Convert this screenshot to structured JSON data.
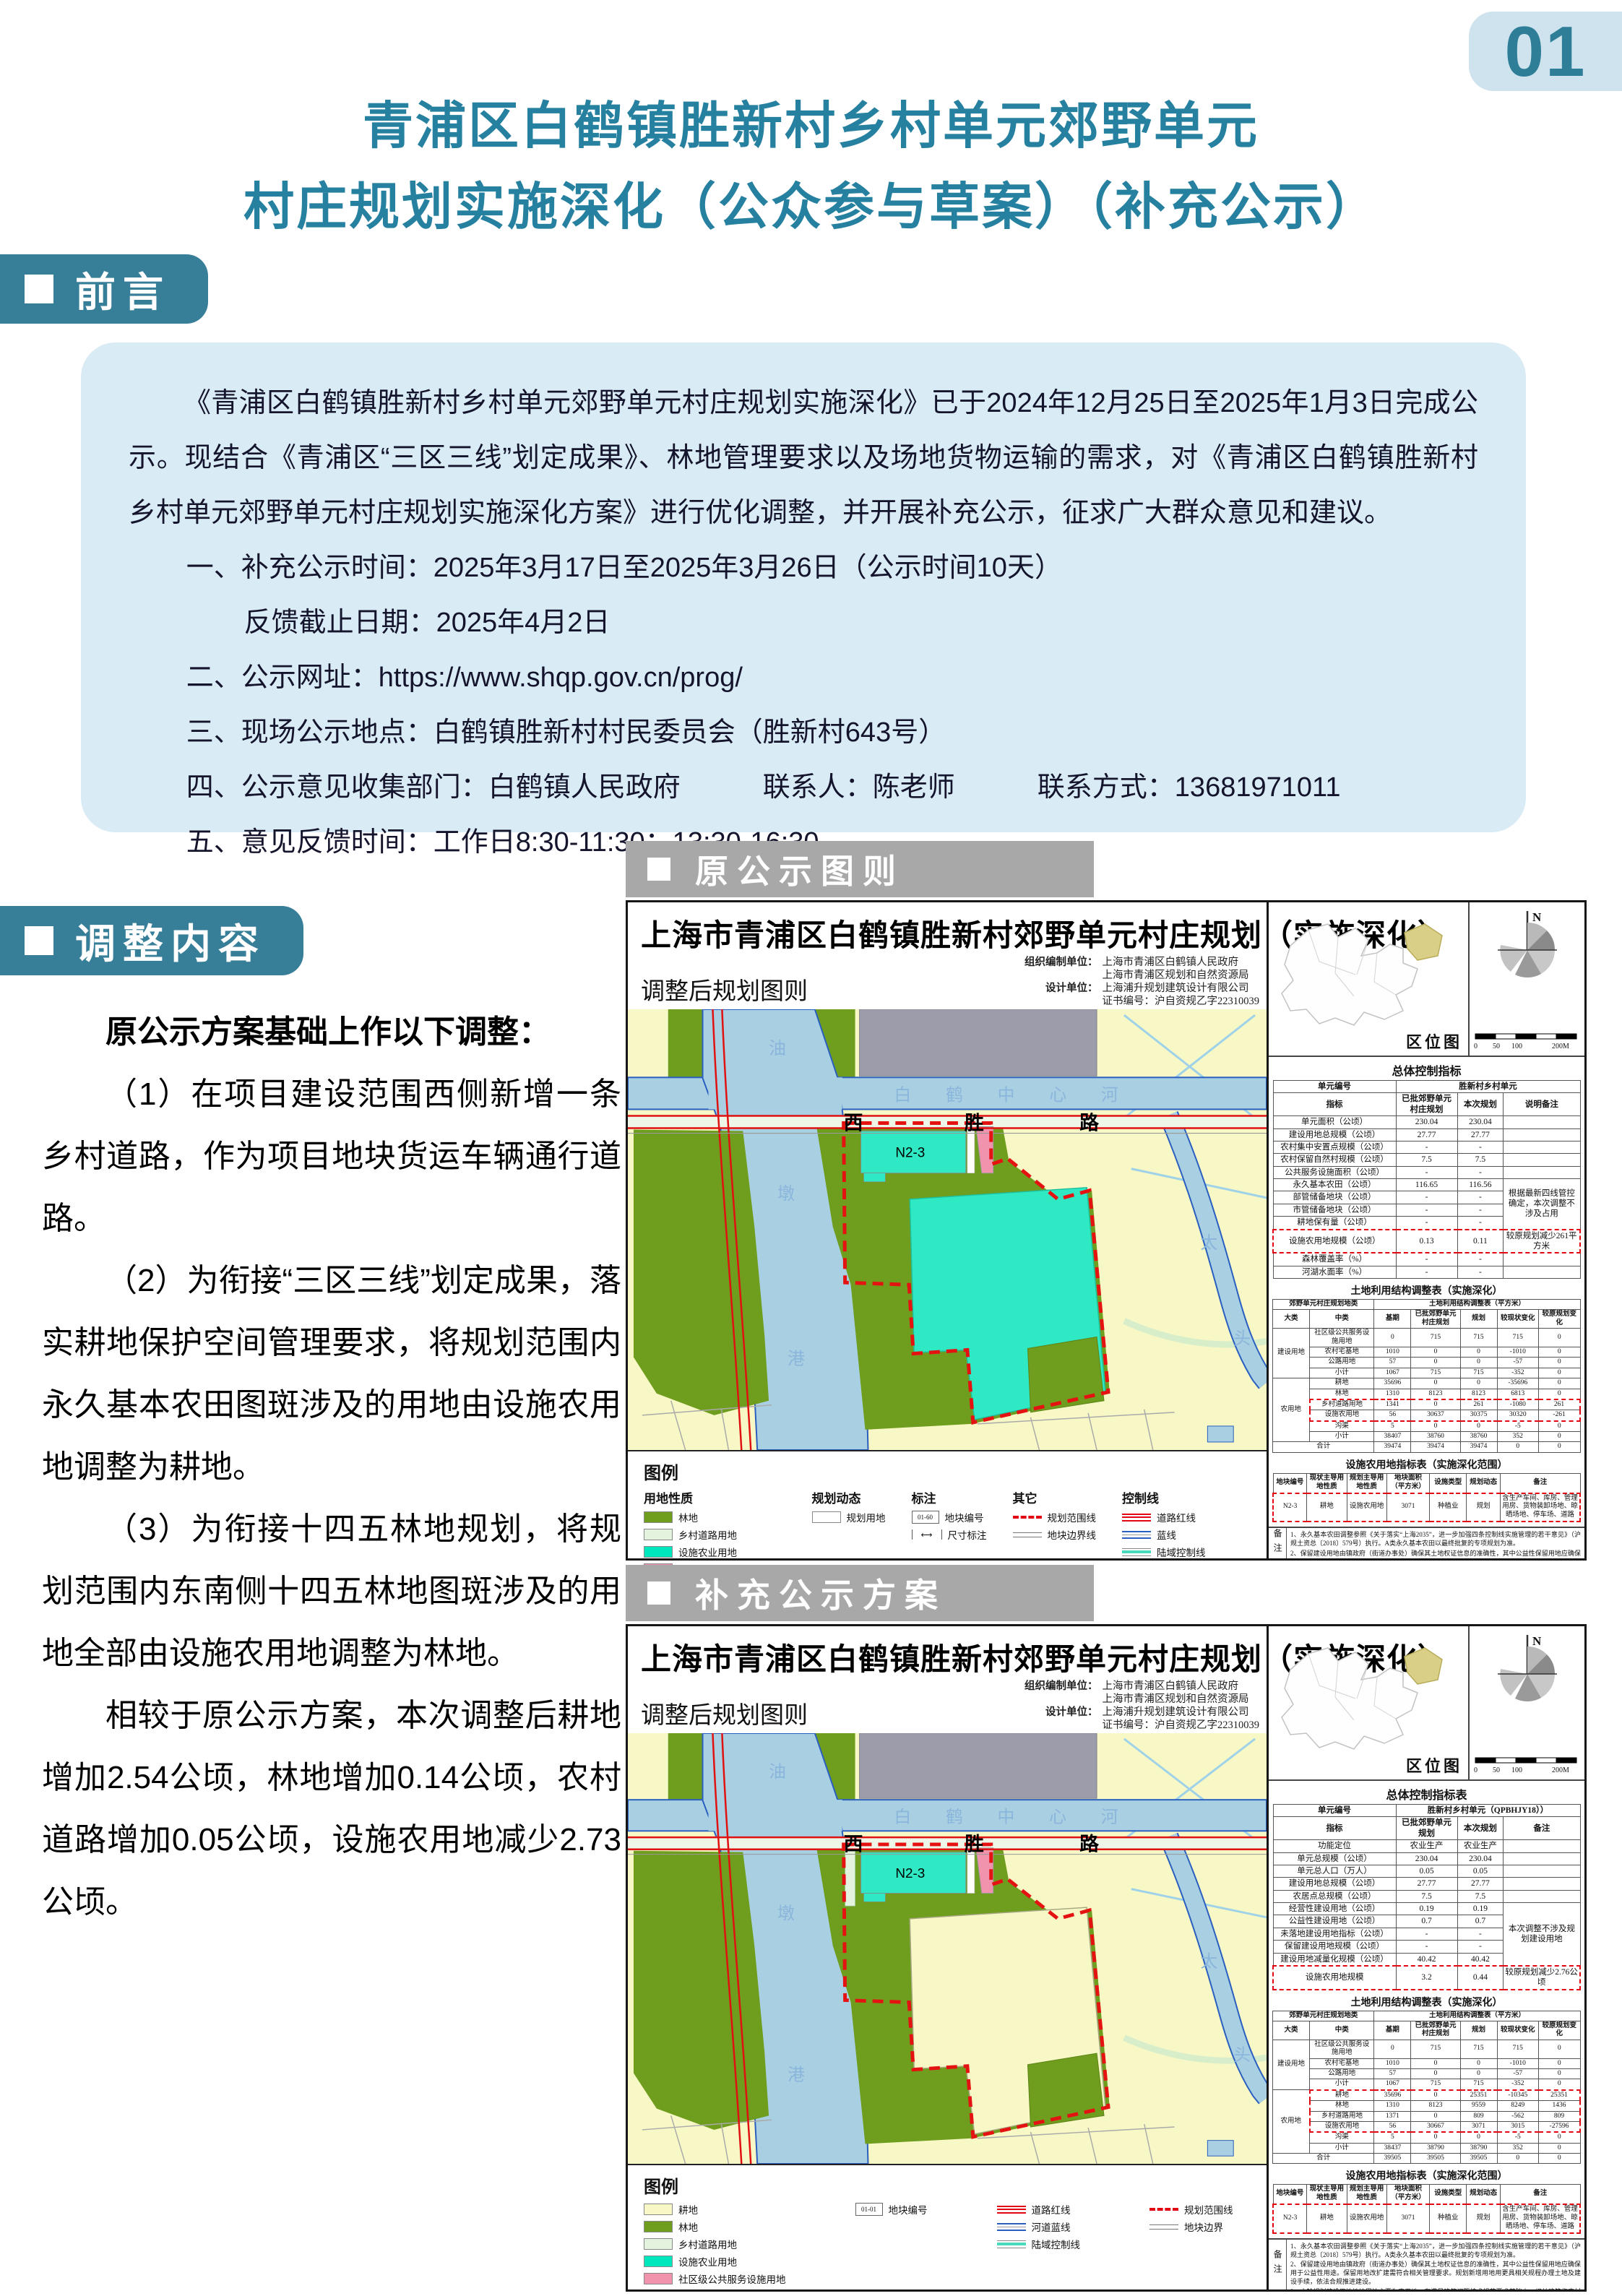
{
  "page": {
    "number": "01"
  },
  "title": {
    "line1": "青浦区白鹤镇胜新村乡村单元郊野单元",
    "line2": "村庄规划实施深化（公众参与草案）（补充公示）"
  },
  "sections": {
    "preface": "前言",
    "adjust": "调整内容"
  },
  "preface": {
    "paragraph": "《青浦区白鹤镇胜新村乡村单元郊野单元村庄规划实施深化》已于2024年12月25日至2025年1月3日完成公示。现结合《青浦区“三区三线”划定成果》、林地管理要求以及场地货物运输的需求，对《青浦区白鹤镇胜新村乡村单元郊野单元村庄规划实施深化方案》进行优化调整，并开展补充公示，征求广大群众意见和建议。",
    "items": [
      "一、补充公示时间：2025年3月17日至2025年3月26日（公示时间10天）",
      "反馈截止日期：2025年4月2日",
      "二、公示网址：https://www.shqp.gov.cn/prog/",
      "三、现场公示地点：白鹤镇胜新村村民委员会（胜新村643号）",
      "四、公示意见收集部门：白鹤镇人民政府　　　联系人：陈老师　　　联系方式：13681971011",
      "五、意见反馈时间：工作日8:30-11:30；13:30-16:30"
    ]
  },
  "adjust": {
    "p0": "原公示方案基础上作以下调整：",
    "p1": "（1）在项目建设范围西侧新增一条乡村道路，作为项目地块货运车辆通行道路。",
    "p2": "（2）为衔接“三区三线”划定成果，落实耕地保护空间管理要求，将规划范围内永久基本农田图斑涉及的用地由设施农用地调整为耕地。",
    "p3": "（3）为衔接十四五林地规划，将规划范围内东南侧十四五林地图斑涉及的用地全部由设施农用地调整为林地。",
    "p4": "相较于原公示方案，本次调整后耕地增加2.54公顷，林地增加0.14公顷，农村道路增加0.05公顷，设施农用地减少2.73公顷。"
  },
  "map_common": {
    "map_title": "上海市青浦区白鹤镇胜新村郊野单元村庄规划（实施深化）",
    "map_subtitle": "调整后规划图则",
    "credits": {
      "row1_label": "组织编制单位：",
      "row1a": "上海市青浦区白鹤镇人民政府",
      "row1b": "上海市青浦区规划和自然资源局",
      "row2_label": "设计单位：",
      "row2a": "上海浦升规划建筑设计有限公司",
      "row2b": "证书编号：沪自资规乙字22310039"
    },
    "loc_label": "区位图",
    "compass": "N",
    "scale": [
      "0",
      "50",
      "100",
      "200M"
    ],
    "facility_title": "设施农用地指标表（实施深化范围）",
    "facility_rows": [
      {
        "cells": [
          {
            "t": "地块编号",
            "h": 1
          },
          {
            "t": "现状主导用地性质",
            "h": 1
          },
          {
            "t": "规划主导用地性质",
            "h": 1
          },
          {
            "t": "地块面积（平方米）",
            "h": 1
          },
          {
            "t": "设施类型",
            "h": 1
          },
          {
            "t": "规划动态",
            "h": 1
          },
          {
            "t": "备注",
            "h": 1
          }
        ]
      },
      {
        "cells": [
          {
            "t": "N2-3",
            "cls": "ht hb hL"
          },
          {
            "t": "耕地",
            "cls": "ht hb"
          },
          {
            "t": "设施农用地",
            "cls": "ht hb"
          },
          {
            "t": "3071",
            "cls": "ht hb"
          },
          {
            "t": "种植业",
            "cls": "ht hb"
          },
          {
            "t": "规划",
            "cls": "ht hb"
          },
          {
            "t": "含生产车间、库房、管理用房、货物装卸场地、晾晒场地、停车场、道路",
            "cls": "ht hb hR"
          }
        ]
      }
    ],
    "notes_label": "备注",
    "notes": [
      "1、永久基本农田调整参照《关于落实“上海2035”，进一步加强四条控制线实施管理的若干意见》（沪规土资总〔2018〕579号）执行。A类永久基本农田以最终批复的专项规划为准。",
      "2、保留建设用地由镇政府（街道办事处）确保其土地权证信息的准确性，其中公益性保留用地应确保用于公益性用途。保留用地改扩建需符合相关管理要求。规划新增用地用更具相关规程办理土地及建设手续，依法合规推进建设。",
      "3、本轮规划建设用地地块周边主要为农用地，在满足建筑间距技术规范要求基础上，相关建筑临农村道路的，建筑控制线不作严格要求。规划对地块内绿地率、停车位等亦不做控制，具体绿地率、停车位等以批准的建设方案为准。",
      "4、本图则可通过村庄规划、村庄设计及图则更新的方式进行调整修订，未来实施过程中遇到产业发展、农民意愿调整等，可适时启动图则修订。"
    ]
  },
  "figure1": {
    "header": "原公示图则",
    "overall_title": "总体控制指标",
    "overall_rows": [
      {
        "cells": [
          {
            "t": "单元编号",
            "h": 1
          },
          {
            "t": "胜新村乡村单元",
            "h": 1,
            "cs": 3
          }
        ]
      },
      {
        "cells": [
          {
            "t": "指标",
            "h": 1
          },
          {
            "t": "已批郊野单元村庄规划",
            "h": 1
          },
          {
            "t": "本次规划",
            "h": 1
          },
          {
            "t": "说明备注",
            "h": 1
          }
        ]
      },
      {
        "cells": [
          "单元面积（公顷）",
          "230.04",
          "230.04",
          ""
        ]
      },
      {
        "cells": [
          "建设用地总规模（公顷）",
          "27.77",
          "27.77",
          ""
        ]
      },
      {
        "cells": [
          "农村集中安置点规模（公顷）",
          "-",
          "-",
          ""
        ]
      },
      {
        "cells": [
          "农村保留自然村规模（公顷）",
          "7.5",
          "7.5",
          ""
        ]
      },
      {
        "cells": [
          "公共服务设施面积（公顷）",
          "-",
          "-",
          ""
        ]
      },
      {
        "cells": [
          "永久基本农田（公顷）",
          "116.65",
          "116.56",
          {
            "t": "根据最新四线管控确定，本次调整不涉及占用",
            "rs": 4
          }
        ]
      },
      {
        "cells": [
          "部管储备地块（公顷）",
          "-",
          "-"
        ]
      },
      {
        "cells": [
          "市管储备地块（公顷）",
          "-",
          "-"
        ]
      },
      {
        "cells": [
          "耕地保有量（公顷）",
          "-",
          "-"
        ]
      },
      {
        "cells": [
          {
            "t": "设施农用地规模（公顷）",
            "cls": "ht hb hL"
          },
          {
            "t": "0.13",
            "cls": "ht hb"
          },
          {
            "t": "0.11",
            "cls": "ht hb"
          },
          {
            "t": "较原规划减少261平方米",
            "cls": "ht hb hR"
          }
        ]
      },
      {
        "cells": [
          "森林覆盖率（%）",
          "-",
          "-",
          ""
        ]
      },
      {
        "cells": [
          "河湖水面率（%）",
          "-",
          "-",
          ""
        ]
      }
    ],
    "landuse_title": "土地利用结构调整表（实施深化）",
    "landuse_rows": [
      {
        "cells": [
          {
            "t": "郊野单元村庄规划地类",
            "h": 1,
            "cs": 2
          },
          {
            "t": "土地利用结构调整表（平方米）",
            "h": 1,
            "cs": 5
          }
        ]
      },
      {
        "cells": [
          {
            "t": "大类",
            "h": 1
          },
          {
            "t": "中类",
            "h": 1
          },
          {
            "t": "基期",
            "h": 1
          },
          {
            "t": "已批郊野单元村庄规划",
            "h": 1
          },
          {
            "t": "规划",
            "h": 1
          },
          {
            "t": "较现状变化",
            "h": 1
          },
          {
            "t": "较原规划变化",
            "h": 1
          }
        ]
      },
      {
        "cells": [
          {
            "t": "建设用地",
            "rs": 4
          },
          "社区级公共服务设施用地",
          "0",
          "715",
          "715",
          "715",
          "0"
        ]
      },
      {
        "cells": [
          "农村宅基地",
          "1010",
          "0",
          "0",
          "-1010",
          "0"
        ]
      },
      {
        "cells": [
          "公路用地",
          "57",
          "0",
          "0",
          "-57",
          "0"
        ]
      },
      {
        "cells": [
          "小计",
          "1067",
          "715",
          "715",
          "-352",
          "0"
        ]
      },
      {
        "cells": [
          {
            "t": "农用地",
            "rs": 6
          },
          "耕地",
          "35696",
          "0",
          "0",
          "-35696",
          "0"
        ]
      },
      {
        "cells": [
          "林地",
          "1310",
          "8123",
          "8123",
          "6813",
          "0"
        ]
      },
      {
        "cells": [
          {
            "t": "乡村道路用地",
            "cls": "ht hL"
          },
          {
            "t": "1341",
            "cls": "ht"
          },
          {
            "t": "0",
            "cls": "ht"
          },
          {
            "t": "261",
            "cls": "ht"
          },
          {
            "t": "-1080",
            "cls": "ht"
          },
          {
            "t": "261",
            "cls": "ht hR"
          }
        ]
      },
      {
        "cells": [
          {
            "t": "设施农用地",
            "cls": "hb hL"
          },
          {
            "t": "56",
            "cls": "hb"
          },
          {
            "t": "30637",
            "cls": "hb"
          },
          {
            "t": "30375",
            "cls": "hb"
          },
          {
            "t": "30320",
            "cls": "hb"
          },
          {
            "t": "-261",
            "cls": "hb hR"
          }
        ]
      },
      {
        "cells": [
          "沟渠",
          "5",
          "0",
          "0",
          "-5",
          "0"
        ]
      },
      {
        "cells": [
          "小计",
          "38407",
          "38760",
          "38760",
          "352",
          "0"
        ]
      },
      {
        "cells": [
          {
            "t": "合计",
            "cs": 2
          },
          "39474",
          "39474",
          "39474",
          "0",
          "0"
        ]
      }
    ],
    "legend": {
      "title": "图例",
      "g_usage": "用地性质",
      "g_dynamic": "规划动态",
      "g_annot": "标注",
      "g_other": "其它",
      "g_control": "控制线",
      "forest": "林地",
      "rural_road": "乡村道路用地",
      "facility": "设施农业用地",
      "community": "社区级公共服务设施用地",
      "planned": "规划用地",
      "parcel_no": "地块编号",
      "parcel_no_box": "01-60",
      "dim": "尺寸标注",
      "dim_icon": "⟷",
      "boundary": "规划范围线",
      "parcel_line": "地块边界线",
      "road_red": "道路红线",
      "blue_line": "蓝线",
      "land_ctrl": "陆域控制线"
    }
  },
  "figure2": {
    "header": "补充公示方案",
    "overall_title": "总体控制指标表",
    "overall_rows": [
      {
        "cells": [
          {
            "t": "单元编号",
            "h": 1
          },
          {
            "t": "胜新村乡村单元（QPBHJY18））",
            "h": 1,
            "cs": 3
          }
        ]
      },
      {
        "cells": [
          {
            "t": "指标",
            "h": 1
          },
          {
            "t": "已批郊野单元规划",
            "h": 1
          },
          {
            "t": "本次规划",
            "h": 1
          },
          {
            "t": "备注",
            "h": 1
          }
        ]
      },
      {
        "cells": [
          "功能定位",
          "农业生产",
          "农业生产",
          ""
        ]
      },
      {
        "cells": [
          "单元总规模（公顷）",
          "230.04",
          "230.04",
          ""
        ]
      },
      {
        "cells": [
          "单元总人口（万人）",
          "0.05",
          "0.05",
          ""
        ]
      },
      {
        "cells": [
          "建设用地总规模（公顷）",
          "27.77",
          "27.77",
          ""
        ]
      },
      {
        "cells": [
          "农居点总规模（公顷）",
          "7.5",
          "7.5",
          ""
        ]
      },
      {
        "cells": [
          "经营性建设用地（公顷）",
          "0.19",
          "0.19",
          {
            "t": "本次调整不涉及规划建设用地",
            "rs": 5
          }
        ]
      },
      {
        "cells": [
          "公益性建设用地（公顷）",
          "0.7",
          "0.7"
        ]
      },
      {
        "cells": [
          "未落地建设用地指标（公顷）",
          "-",
          "-"
        ]
      },
      {
        "cells": [
          "保留建设用地规模（公顷）",
          "-",
          "-"
        ]
      },
      {
        "cells": [
          "建设用地减量化规模（公顷）",
          "40.42",
          "40.42"
        ]
      },
      {
        "cells": [
          {
            "t": "设施农用地规模",
            "cls": "ht hb hL"
          },
          {
            "t": "3.2",
            "cls": "ht hb"
          },
          {
            "t": "0.44",
            "cls": "ht hb"
          },
          {
            "t": "较原规划减少2.76公顷",
            "cls": "ht hb hR"
          }
        ]
      }
    ],
    "landuse_title": "土地利用结构调整表（实施深化）",
    "landuse_rows": [
      {
        "cells": [
          {
            "t": "郊野单元村庄规划地类",
            "h": 1,
            "cs": 2
          },
          {
            "t": "土地利用结构调整表（平方米）",
            "h": 1,
            "cs": 5
          }
        ]
      },
      {
        "cells": [
          {
            "t": "大类",
            "h": 1
          },
          {
            "t": "中类",
            "h": 1
          },
          {
            "t": "基期",
            "h": 1
          },
          {
            "t": "已批郊野单元村庄规划",
            "h": 1
          },
          {
            "t": "规划",
            "h": 1
          },
          {
            "t": "较现状变化",
            "h": 1
          },
          {
            "t": "较原规划变化",
            "h": 1
          }
        ]
      },
      {
        "cells": [
          {
            "t": "建设用地",
            "rs": 4
          },
          "社区级公共服务设施用地",
          "0",
          "715",
          "715",
          "715",
          "0"
        ]
      },
      {
        "cells": [
          "农村宅基地",
          "1010",
          "0",
          "0",
          "-1010",
          "0"
        ]
      },
      {
        "cells": [
          "公路用地",
          "57",
          "0",
          "0",
          "-57",
          "0"
        ]
      },
      {
        "cells": [
          "小计",
          "1067",
          "715",
          "715",
          "-352",
          "0"
        ]
      },
      {
        "cells": [
          {
            "t": "农用地",
            "rs": 6
          },
          {
            "t": "耕地",
            "cls": "ht hL"
          },
          {
            "t": "35696",
            "cls": "ht"
          },
          {
            "t": "0",
            "cls": "ht"
          },
          {
            "t": "25351",
            "cls": "ht"
          },
          {
            "t": "-10345",
            "cls": "ht"
          },
          {
            "t": "25351",
            "cls": "ht hR"
          }
        ]
      },
      {
        "cells": [
          {
            "t": "林地",
            "cls": "hL"
          },
          "1310",
          "8123",
          "9559",
          "8249",
          {
            "t": "1436",
            "cls": "hR"
          }
        ]
      },
      {
        "cells": [
          {
            "t": "乡村道路用地",
            "cls": "hL"
          },
          "1371",
          "0",
          "809",
          "-562",
          {
            "t": "809",
            "cls": "hR"
          }
        ]
      },
      {
        "cells": [
          {
            "t": "设施农用地",
            "cls": "hb hL"
          },
          {
            "t": "56",
            "cls": "hb"
          },
          {
            "t": "30667",
            "cls": "hb"
          },
          {
            "t": "3071",
            "cls": "hb"
          },
          {
            "t": "3015",
            "cls": "hb"
          },
          {
            "t": "-27596",
            "cls": "hb hR"
          }
        ]
      },
      {
        "cells": [
          "沟渠",
          "5",
          "0",
          "0",
          "-5",
          "0"
        ]
      },
      {
        "cells": [
          "小计",
          "38437",
          "38790",
          "38790",
          "352",
          "0"
        ]
      },
      {
        "cells": [
          {
            "t": "合计",
            "cs": 2
          },
          "39505",
          "39505",
          "39505",
          "0",
          "0"
        ]
      }
    ],
    "legend": {
      "title": "图例",
      "farmland": "耕地",
      "forest": "林地",
      "rural_road": "乡村道路用地",
      "facility": "设施农业用地",
      "community": "社区级公共服务设施用地",
      "parcel_no": "地块编号",
      "parcel_no_box": "01-01",
      "road_red": "道路红线",
      "river_blue": "河道蓝线",
      "land_ctrl": "陆域控制线",
      "boundary": "规划范围线",
      "parcel_line": "地块边界"
    }
  },
  "map_labels": {
    "road": [
      "西",
      "胜",
      "路"
    ],
    "h_river": "白　　鹤　　中　　心　　河",
    "v_river": [
      "油",
      "墩",
      "港"
    ],
    "r_river": [
      "太",
      "头"
    ],
    "parcel": "N2-3"
  },
  "colors": {
    "accent_teal": "#2f7e98",
    "badge_bg": "#377f98",
    "page_badge_bg": "#cfe3ee",
    "intro_bg": "#d9ebf5",
    "header_gray": "#a8a8a8",
    "water": "#a9cfe2",
    "water_edge": "#2a5fc0",
    "forest": "#6f9d1e",
    "farmland": "#f8f8c6",
    "facility_cyan": "#00e7be",
    "facility_parcel": "#2fe9c4",
    "rural_road": "#e3f3dd",
    "community_pink": "#f193ac",
    "boundary_red": "#e30613",
    "gray_block": "#9c9cab"
  }
}
